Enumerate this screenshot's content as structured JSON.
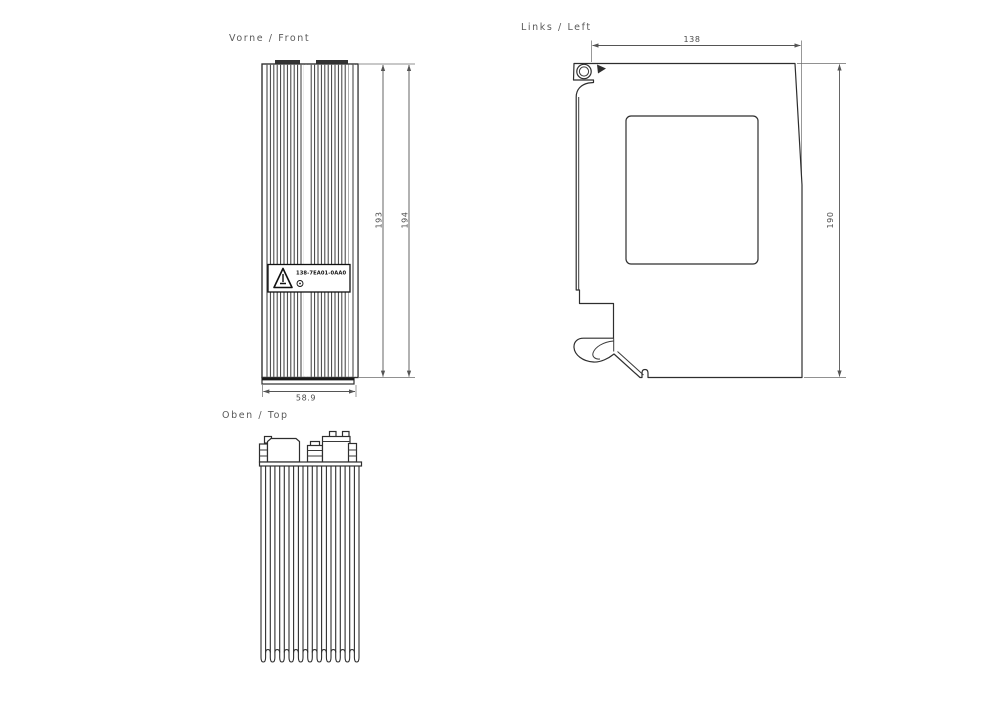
{
  "drawing": {
    "front": {
      "title": "Vorne / Front",
      "dim_height_inner": "193",
      "dim_height_outer": "194",
      "dim_width": "58.9",
      "part_number": "138-7EA01-0AA0"
    },
    "left": {
      "title": "Links / Left",
      "dim_width": "138",
      "dim_height": "190"
    },
    "top": {
      "title": "Oben / Top"
    }
  },
  "colors": {
    "outline": "#2e2e2e",
    "dimension_text": "#4a4a4a",
    "title_text": "#5a5a5a",
    "background": "#ffffff"
  }
}
